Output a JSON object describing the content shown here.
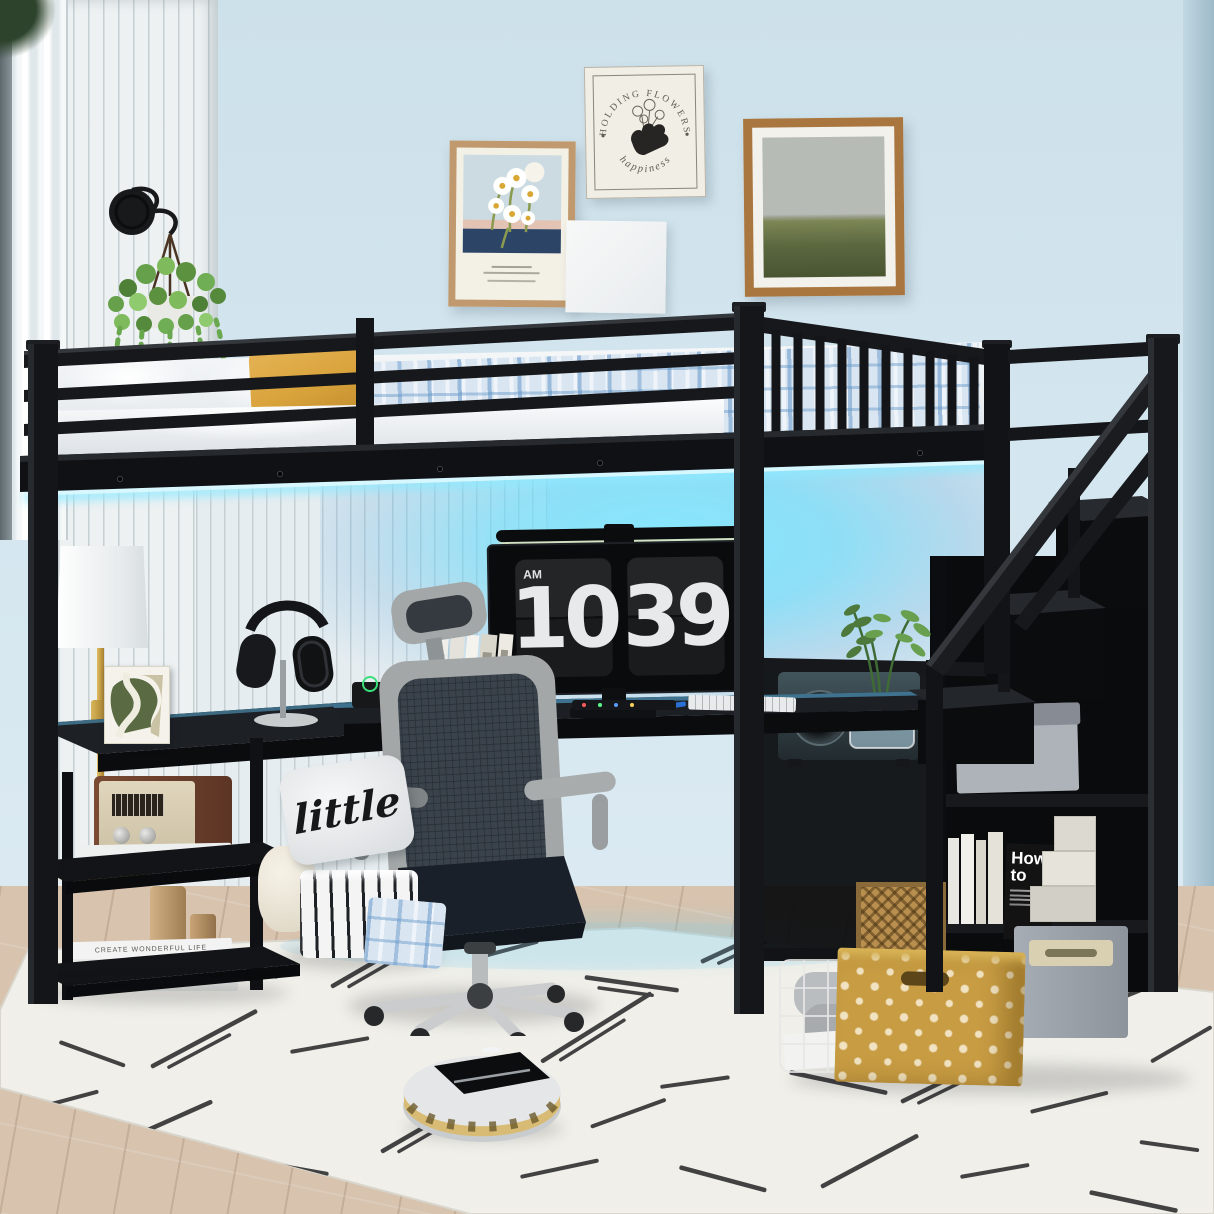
{
  "clock": {
    "meridiem": "AM",
    "hour": "10",
    "minute": "39"
  },
  "pillow": {
    "word": "little"
  },
  "prints": {
    "arc_top": "HOLDING FLOWERS",
    "arc_bottom": "happiness"
  },
  "books": {
    "black_book_line1": "How",
    "black_book_line2": "to",
    "spine_top": "CREATE WONDERFUL LIFE",
    "spine_bottom": "The Most Excellent"
  },
  "colors": {
    "led-cyan": "#5ed9fb",
    "metal-black": "#17181b",
    "wall-blue": "#d3e5ee",
    "gold-accent": "#c9a24b",
    "pillow-yellow": "#d9a33c",
    "plaid-blue": "#8fb4d6",
    "rug-white": "#f0efe9",
    "wood-floor": "#d7c3ae"
  }
}
